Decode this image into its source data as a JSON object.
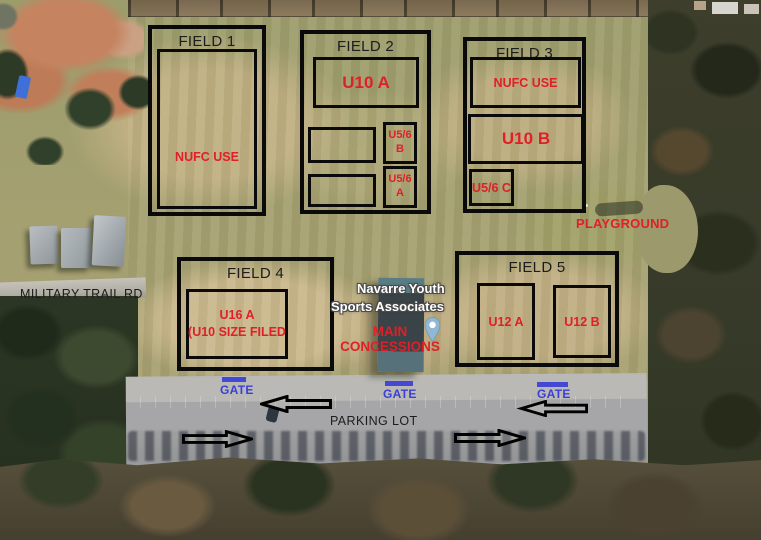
{
  "map": {
    "road_label": "MILITARY TRAIL RD",
    "parking_label": "PARKING LOT",
    "playground_label": "PLAYGROUND",
    "venue_label": {
      "line1": "Navarre Youth",
      "line2": "Sports Associates"
    },
    "concessions_label": {
      "line1": "MAIN",
      "line2": "CONCESSIONS"
    },
    "gates": [
      {
        "label": "GATE"
      },
      {
        "label": "GATE"
      },
      {
        "label": "GATE"
      }
    ],
    "fields": {
      "field1": {
        "title": "FIELD 1",
        "inner": "NUFC USE"
      },
      "field2": {
        "title": "FIELD 2",
        "u10a": "U10 A",
        "u56b": "U5/6 B",
        "u56a": "U5/6 A"
      },
      "field3": {
        "title": "FIELD 3",
        "nufc": "NUFC USE",
        "u10b": "U10 B",
        "u56c": "U5/6 C"
      },
      "field4": {
        "title": "FIELD 4",
        "u16a": "U16 A",
        "u16a_note": "(U10 SIZE FILED"
      },
      "field5": {
        "title": "FIELD 5",
        "u12a": "U12 A",
        "u12b": "U12 B"
      }
    },
    "icons": {
      "map_pin": "map-pin-icon",
      "arrow_left": "arrow-left-icon",
      "arrow_right": "arrow-right-icon",
      "gate_bar": "gate-marker-bar"
    },
    "colors": {
      "annotation_red": "#e01f26",
      "gate_blue": "#3a3fd6",
      "outline_black": "#0a0a0a",
      "pin_blue": "#8fb7d6",
      "venue_text": "#ffffff"
    }
  }
}
